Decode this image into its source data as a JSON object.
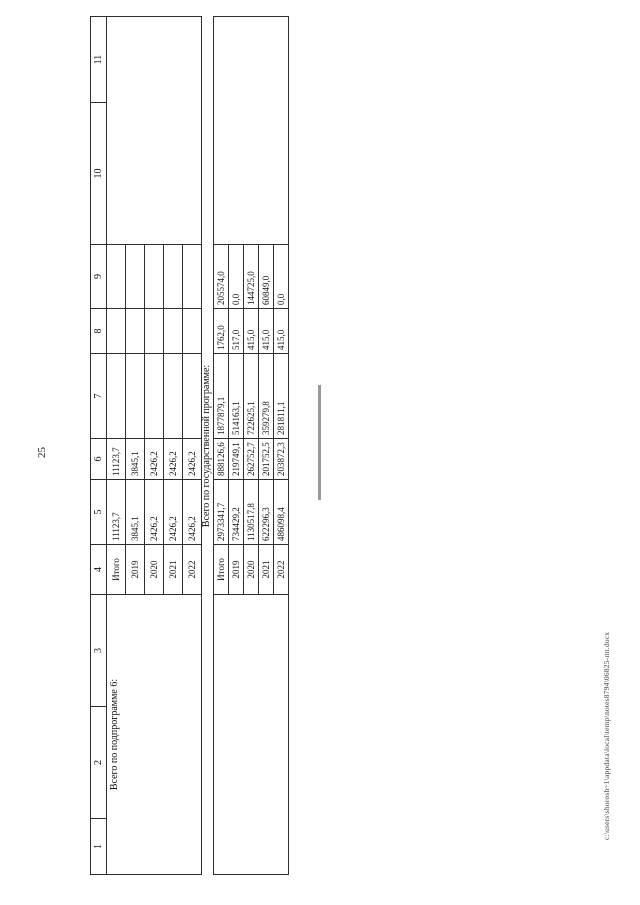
{
  "page": {
    "number": "25",
    "footer_path": "c:\\users\\shorosh~1\\appdata\\local\\temp\\notes8794\\06825-пп.docx"
  },
  "table": {
    "header": [
      "1",
      "2",
      "3",
      "4",
      "5",
      "6",
      "7",
      "8",
      "9",
      "10",
      "11"
    ],
    "section1": {
      "label": "Всего по подпрограмме 6:",
      "rows": [
        {
          "period": "Итого",
          "c5": "11123,7",
          "c6": "11123,7"
        },
        {
          "period": "2019",
          "c5": "3845,1",
          "c6": "3845,1"
        },
        {
          "period": "2020",
          "c5": "2426,2",
          "c6": "2426,2"
        },
        {
          "period": "2021",
          "c5": "2426,2",
          "c6": "2426,2"
        },
        {
          "period": "2022",
          "c5": "2426,2",
          "c6": "2426,2"
        }
      ]
    },
    "divider": "Всего по государственной программе:",
    "section2": {
      "rows": [
        {
          "period": "Итого",
          "c5": "2973341,7",
          "c6": "888126,6",
          "c7": "1877879,1",
          "c8": "1762,0",
          "c9": "205574,0"
        },
        {
          "period": "2019",
          "c5": "734429,2",
          "c6": "219749,1",
          "c7": "514163,1",
          "c8": "517,0",
          "c9": "0,0"
        },
        {
          "period": "2020",
          "c5": "1130517,8",
          "c6": "262752,7",
          "c7": "722625,1",
          "c8": "415,0",
          "c9": "144725,0"
        },
        {
          "period": "2021",
          "c5": "622296,3",
          "c6": "201752,5",
          "c7": "359279,8",
          "c8": "415,0",
          "c9": "60849,0"
        },
        {
          "period": "2022",
          "c5": "486098,4",
          "c6": "203872,3",
          "c7": "281811,1",
          "c8": "415,0",
          "c9": "0,0"
        }
      ]
    }
  }
}
